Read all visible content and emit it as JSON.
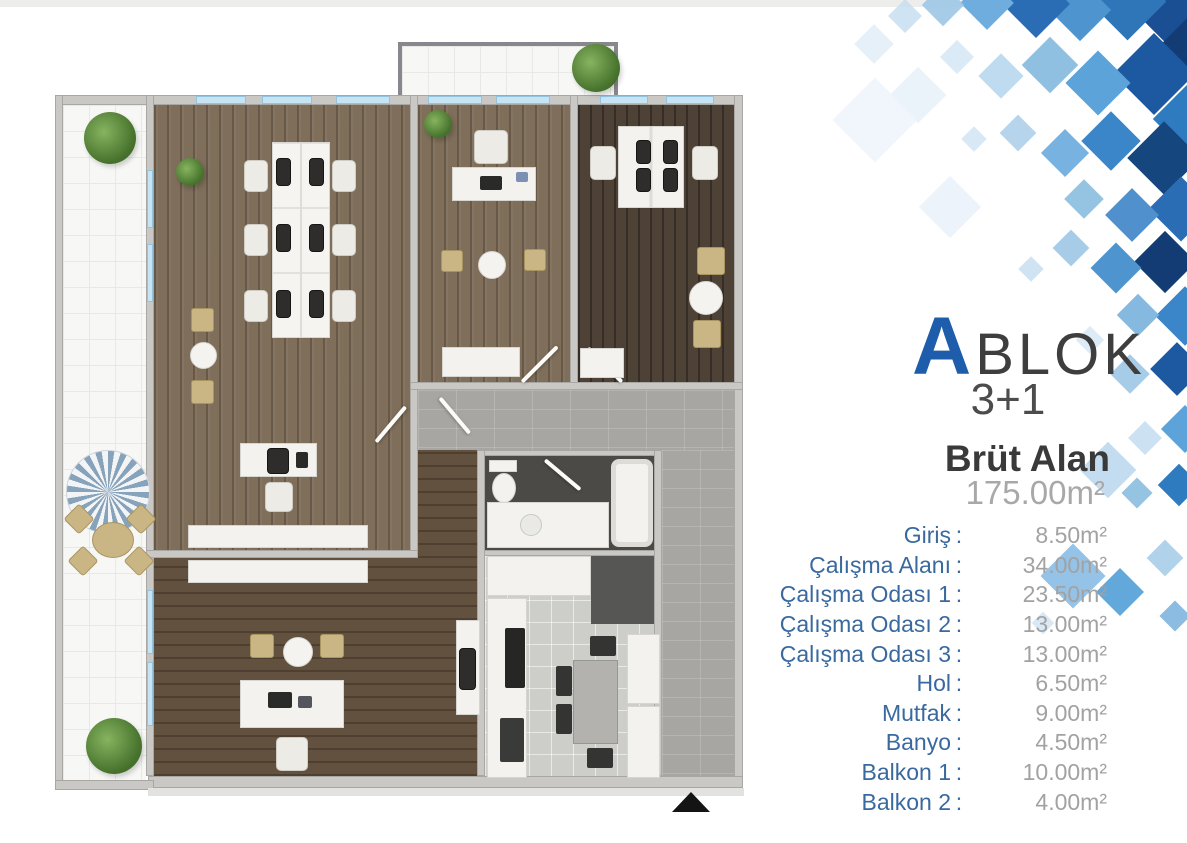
{
  "legend": {
    "block_letter": "A",
    "block_word": "BLOK",
    "unit_type": "3+1",
    "gross_area_label": "Brüt Alan",
    "gross_area_value": "175.00m²",
    "separator": ":",
    "rooms": [
      {
        "label": "Giriş",
        "value": "8.50m²"
      },
      {
        "label": "Çalışma Alanı",
        "value": "34.00m²"
      },
      {
        "label": "Çalışma Odası 1",
        "value": "23.50m²"
      },
      {
        "label": "Çalışma Odası 2",
        "value": "13.00m²"
      },
      {
        "label": "Çalışma Odası 3",
        "value": "13.00m²"
      },
      {
        "label": "Hol",
        "value": "6.50m²"
      },
      {
        "label": "Mutfak",
        "value": "9.00m²"
      },
      {
        "label": "Banyo",
        "value": "4.50m²"
      },
      {
        "label": "Balkon 1",
        "value": "10.00m²"
      },
      {
        "label": "Balkon 2",
        "value": "4.00m²"
      }
    ]
  },
  "floorplan": {
    "north_arrow_icon": "triangle-up"
  },
  "colors": {
    "accent_blue": "#1d5dab",
    "label_blue": "#39699e",
    "value_gray": "#a2a2a2"
  },
  "decor": {
    "diamonds": [
      [
        1148,
        -20,
        64,
        "#1b4f93",
        1
      ],
      [
        1100,
        -26,
        55,
        "#2e76b8",
        1
      ],
      [
        1058,
        -12,
        44,
        "#4e95d0",
        1
      ],
      [
        1012,
        -20,
        48,
        "#2a6db5",
        1
      ],
      [
        968,
        -16,
        38,
        "#6fadde",
        1
      ],
      [
        928,
        -10,
        30,
        "#9cc6e6",
        0.9
      ],
      [
        893,
        4,
        24,
        "#c3dcf0",
        0.8
      ],
      [
        1172,
        18,
        52,
        "#123c73",
        1
      ],
      [
        1125,
        45,
        58,
        "#1d59a0",
        1
      ],
      [
        1075,
        60,
        46,
        "#5ba3d9",
        1
      ],
      [
        1030,
        45,
        40,
        "#8abddf",
        0.95
      ],
      [
        985,
        60,
        32,
        "#b8d7ee",
        0.9
      ],
      [
        945,
        45,
        24,
        "#d4e6f5",
        0.85
      ],
      [
        1164,
        92,
        54,
        "#2f7bbf",
        1
      ],
      [
        898,
        75,
        40,
        "#e8f1f9",
        0.9
      ],
      [
        860,
        30,
        28,
        "#dbe9f6",
        0.7
      ],
      [
        1138,
        132,
        52,
        "#16467e",
        1
      ],
      [
        1090,
        120,
        42,
        "#3b86c8",
        1
      ],
      [
        1048,
        136,
        34,
        "#70aede",
        0.95
      ],
      [
        1005,
        120,
        26,
        "#a9cde9",
        0.85
      ],
      [
        1158,
        186,
        46,
        "#2a6db5",
        1
      ],
      [
        1113,
        196,
        38,
        "#5090cc",
        1
      ],
      [
        1070,
        185,
        28,
        "#8abddf",
        0.9
      ],
      [
        965,
        130,
        18,
        "#cfe2f3",
        0.8
      ],
      [
        928,
        185,
        44,
        "#eaf2fa",
        0.9
      ],
      [
        1143,
        240,
        44,
        "#123c73",
        1
      ],
      [
        1098,
        250,
        36,
        "#4e95d0",
        1
      ],
      [
        1058,
        235,
        26,
        "#9cc6e6",
        0.9
      ],
      [
        1164,
        295,
        42,
        "#3b86c8",
        1
      ],
      [
        1123,
        300,
        30,
        "#7fb5de",
        0.95
      ],
      [
        1022,
        260,
        18,
        "#c3dcf0",
        0.8
      ],
      [
        1158,
        350,
        38,
        "#1d59a0",
        1
      ],
      [
        1116,
        360,
        28,
        "#9cc6e6",
        0.9
      ],
      [
        1168,
        412,
        34,
        "#5ba3d9",
        1
      ],
      [
        1133,
        426,
        24,
        "#c3dcf0",
        0.85
      ],
      [
        1080,
        330,
        20,
        "#d4e6f5",
        0.8
      ],
      [
        1164,
        470,
        30,
        "#2f7bbf",
        1
      ],
      [
        1126,
        482,
        22,
        "#8abddf",
        0.9
      ],
      [
        1088,
        450,
        40,
        "#bcd8ee",
        0.9
      ],
      [
        1050,
        553,
        46,
        "#8fc0e6",
        0.95
      ],
      [
        1103,
        575,
        34,
        "#5ba3d9",
        0.95
      ],
      [
        1152,
        545,
        26,
        "#a9cde9",
        0.9
      ],
      [
        1164,
        605,
        22,
        "#7fb5de",
        0.9
      ],
      [
        1035,
        615,
        16,
        "#cfe2f3",
        0.8
      ],
      [
        845,
        90,
        60,
        "#eef5fb",
        0.85
      ]
    ]
  }
}
